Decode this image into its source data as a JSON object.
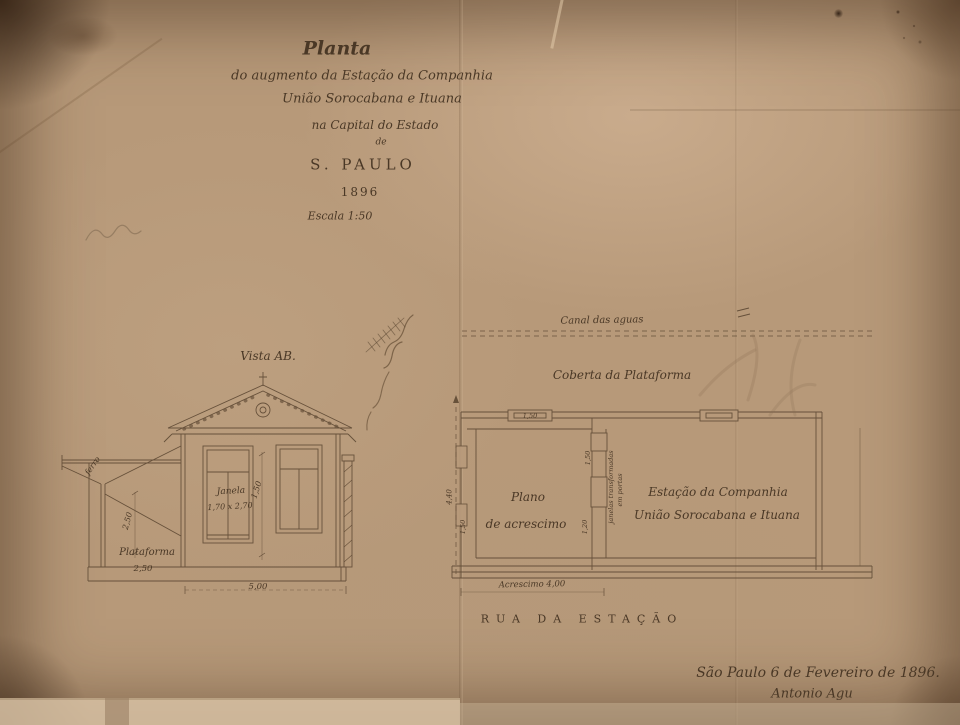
{
  "drawing": {
    "title": {
      "l1": "Planta",
      "l2": "do augmento da Estação da Companhia",
      "l3": "União Sorocabana e Ituana",
      "l4": "na Capital do Estado",
      "l5": "de",
      "l6": "S. PAULO",
      "l7": "1896",
      "l8": "Escala 1:50"
    },
    "elevation": {
      "view_label": "Vista AB.",
      "window_name": "Janela",
      "window_size": "1,70 x 2,70",
      "dim_between_windows": "1,50",
      "awning_material": "ferro",
      "dim_awning_height": "2,50",
      "platform_label": "Plataforma",
      "dim_platform_height": "2,50",
      "dim_base_width": "5,00"
    },
    "plan": {
      "canal_label": "Canal das aguas",
      "cover_label": "Coberta da Plataforma",
      "new_room_l1": "Plano",
      "new_room_l2": "de acrescimo",
      "station_l1": "Estação da Companhia",
      "station_l2": "União Sorocabana e Ituana",
      "wall_note_l1": "janelas transformadas",
      "wall_note_l2": "em portas",
      "dim_top_opening": "1,50",
      "dim_door_upper": "1,50",
      "dim_door_lower": "1,20",
      "dim_left_opening": "1,50",
      "dim_depth": "4,40",
      "dim_extension": "Acrescimo 4,00"
    },
    "street_label": "RUA DA ESTAÇÃO",
    "signature": {
      "l1": "São Paulo 6 de Fevereiro de 1896.",
      "l2": "Antonio Agu"
    }
  },
  "colors": {
    "paper": "#b79979",
    "ink": "#4a3826",
    "pencil": "#6f5a44"
  }
}
